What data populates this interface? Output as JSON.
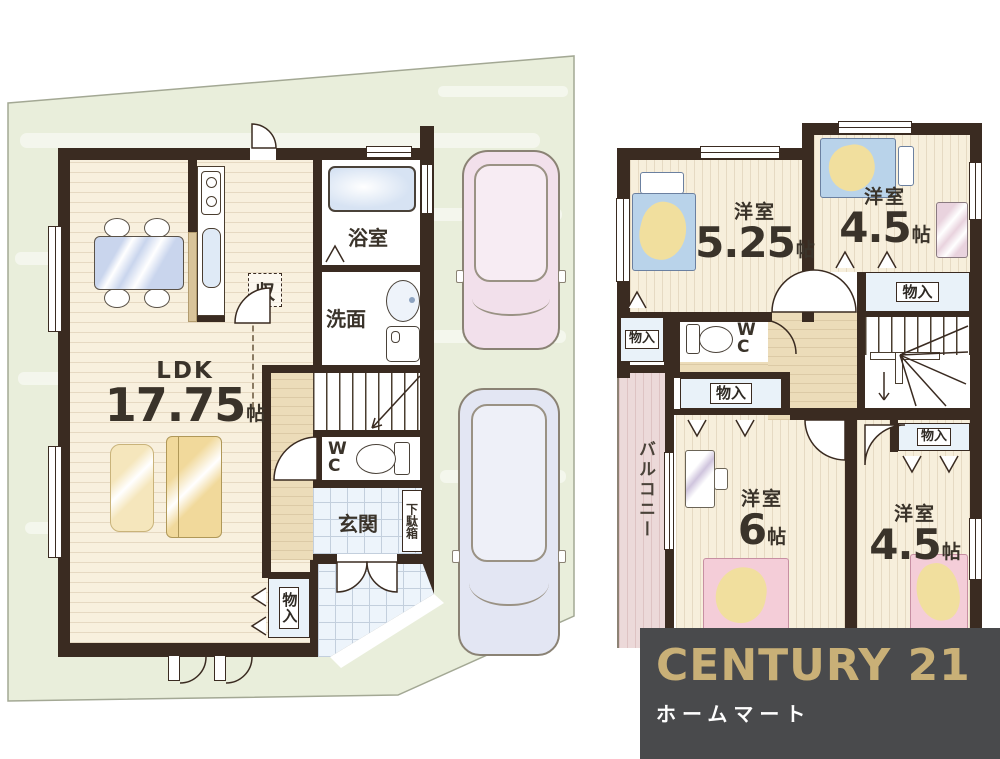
{
  "floor1": {
    "ldk": {
      "name": "LDK",
      "size_num": "17.75",
      "size_unit": "帖"
    },
    "bath_label": "浴室",
    "washroom_label": "洗面",
    "wc_label": "WC",
    "entrance_label": "玄関",
    "shoebox_label": "下駄箱",
    "closet_label": "収",
    "storage_label": "物入"
  },
  "floor2": {
    "bedroom1": {
      "name": "洋室",
      "size_num": "5.25",
      "size_unit": "帖"
    },
    "bedroom2": {
      "name": "洋室",
      "size_num": "4.5",
      "size_unit": "帖"
    },
    "bedroom3": {
      "name": "洋室",
      "size_num": "6",
      "size_unit": "帖"
    },
    "bedroom4": {
      "name": "洋室",
      "size_num": "4.5",
      "size_unit": "帖"
    },
    "wc_label": "WC",
    "balcony_label": "バルコニー",
    "storage_label": "物入"
  },
  "logo": {
    "brand": "CENTURY 21",
    "company": "ホームマート"
  },
  "colors": {
    "wall": "#3a2b21",
    "floor_cream": "#f8f0de",
    "hall_tan": "#ecdcb9",
    "lot_green": "#e9eedb",
    "tile_blue": "#edf4fb",
    "balcony_pink": "#ecd9d9",
    "logo_bg": "#494a4c",
    "logo_gold": "#c9b077",
    "car_pink": "#f2e0eb",
    "car_lavender": "#e3e6f3",
    "bed_blue": "#b9d3ea",
    "blanket_yellow": "#f1df9e",
    "bed_pink": "#f4cdd8",
    "sofa_yellow": "#f1d99b"
  }
}
